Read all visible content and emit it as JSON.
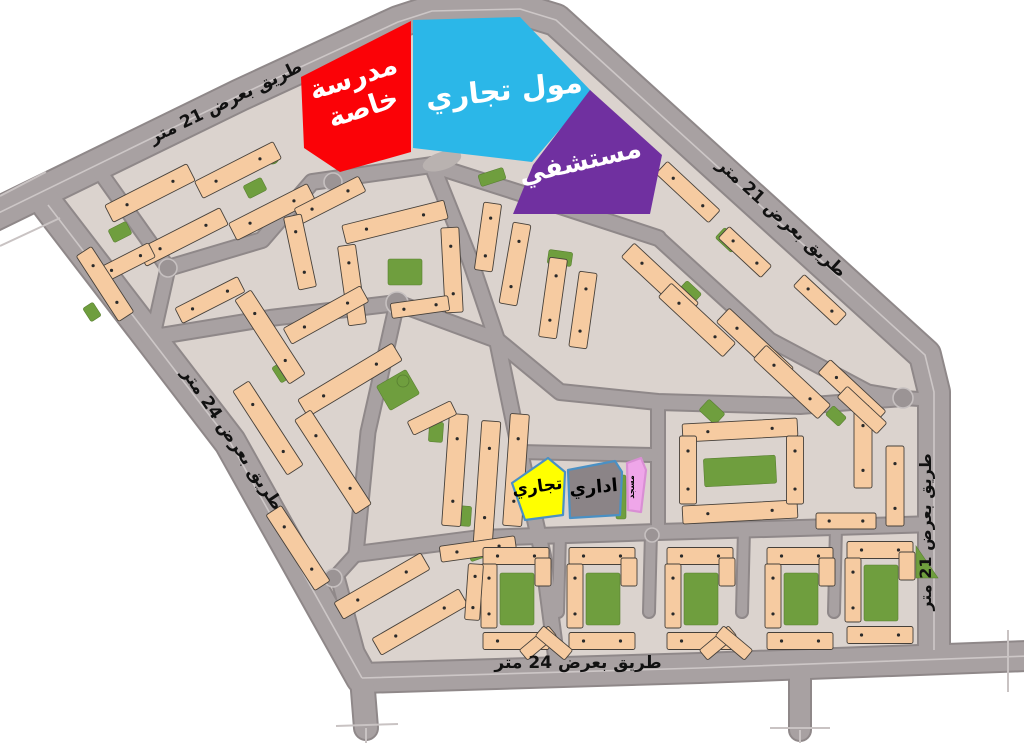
{
  "meta": {
    "description": "Site plan map of a residential district with labeled land-use zones and road widths",
    "background": "#ffffff"
  },
  "colors": {
    "ground": "#dbd3ce",
    "road": "#a8a1a2",
    "road_edge": "#8f8889",
    "road_centerline": "#cdc7c7",
    "tick": "#c9c3c3",
    "building": "#f6cba1",
    "building_stroke": "#46403a",
    "green": "#6f9e3e",
    "green_stroke": "#587f31",
    "oval": "#b9b2b0",
    "roundabout_fill": "#9b9495",
    "roundabout_ring": "#c6c0c0"
  },
  "zones": [
    {
      "id": "private-school",
      "label": "مدرسة خاصة",
      "lines": [
        "مدرسة",
        "خاصة"
      ],
      "fill": "#fb0207",
      "stroke": "none",
      "text_color": "#ffffff",
      "font_size": 27,
      "label_x": 356,
      "label_y": 86,
      "label_rot": -18,
      "points": [
        [
          411,
          21
        ],
        [
          301,
          77
        ],
        [
          304,
          148
        ],
        [
          340,
          172
        ],
        [
          411,
          152
        ]
      ]
    },
    {
      "id": "commercial-mall",
      "label": "مول تجاري",
      "fill": "#2bb7e8",
      "stroke": "none",
      "text_color": "#ffffff",
      "font_size": 29,
      "label_x": 505,
      "label_y": 100,
      "label_rot": -6,
      "points": [
        [
          413,
          20
        ],
        [
          520,
          17
        ],
        [
          592,
          92
        ],
        [
          532,
          162
        ],
        [
          413,
          148
        ]
      ]
    },
    {
      "id": "hospital",
      "label": "مستشفي",
      "fill": "#7030a0",
      "stroke": "none",
      "text_color": "#ffffff",
      "font_size": 26,
      "label_x": 582,
      "label_y": 170,
      "label_rot": -13,
      "points": [
        [
          590,
          90
        ],
        [
          662,
          155
        ],
        [
          650,
          214
        ],
        [
          513,
          214
        ],
        [
          533,
          165
        ]
      ]
    },
    {
      "id": "commercial",
      "label": "تجاري",
      "fill": "#ffff00",
      "stroke": "#4a90c4",
      "text_color": "#000000",
      "font_size": 17,
      "label_x": 538,
      "label_y": 492,
      "label_rot": -8,
      "points": [
        [
          512,
          483
        ],
        [
          548,
          458
        ],
        [
          565,
          472
        ],
        [
          563,
          515
        ],
        [
          525,
          520
        ]
      ]
    },
    {
      "id": "admin",
      "label": "اداري",
      "fill": "#8b8487",
      "stroke": "#4a90c4",
      "text_color": "#000000",
      "font_size": 18,
      "label_x": 594,
      "label_y": 493,
      "label_rot": -5,
      "points": [
        [
          568,
          470
        ],
        [
          615,
          461
        ],
        [
          622,
          472
        ],
        [
          620,
          515
        ],
        [
          570,
          518
        ]
      ]
    },
    {
      "id": "mosque",
      "label": "مسجد",
      "fill": "#efa6e9",
      "stroke": "#d98fd4",
      "text_color": "#000000",
      "font_size": 8,
      "label_x": 634,
      "label_y": 487,
      "label_rot": -90,
      "points": [
        [
          627,
          463
        ],
        [
          641,
          458
        ],
        [
          646,
          470
        ],
        [
          641,
          512
        ],
        [
          628,
          510
        ]
      ]
    }
  ],
  "road_labels": [
    {
      "id": "road-top-left",
      "text": "طريق بعرض 21 متر",
      "x": 228,
      "y": 107,
      "rot": -26,
      "size": 17
    },
    {
      "id": "road-top-right",
      "text": "طريق بعرض 21 متر",
      "x": 778,
      "y": 222,
      "rot": 42,
      "size": 17
    },
    {
      "id": "road-left",
      "text": "طريق بعرض 24 متر",
      "x": 228,
      "y": 442,
      "rot": 56,
      "size": 17
    },
    {
      "id": "road-bottom",
      "text": "طريق بعرض 24 متر",
      "x": 578,
      "y": 668,
      "rot": 0,
      "size": 17
    },
    {
      "id": "road-right",
      "text": "طريق بعرض 21 متر",
      "x": 931,
      "y": 532,
      "rot": -90,
      "size": 16
    }
  ],
  "map": {
    "outline": [
      [
        48,
        205
      ],
      [
        240,
        95
      ],
      [
        398,
        22
      ],
      [
        432,
        11
      ],
      [
        520,
        9
      ],
      [
        556,
        20
      ],
      [
        925,
        355
      ],
      [
        934,
        392
      ],
      [
        934,
        650
      ],
      [
        700,
        668
      ],
      [
        362,
        678
      ],
      [
        230,
        442
      ]
    ],
    "roads": [
      {
        "w": 30,
        "pts": [
          [
            -20,
            222
          ],
          [
            240,
            95
          ],
          [
            398,
            22
          ],
          [
            432,
            11
          ],
          [
            520,
            9
          ],
          [
            556,
            20
          ],
          [
            925,
            355
          ],
          [
            934,
            392
          ],
          [
            934,
            650
          ]
        ],
        "main": true
      },
      {
        "w": 28,
        "pts": [
          [
            362,
            678
          ],
          [
            700,
            668
          ],
          [
            1028,
            656
          ]
        ],
        "main": true
      },
      {
        "w": 30,
        "pts": [
          [
            48,
            205
          ],
          [
            230,
            442
          ],
          [
            362,
            678
          ]
        ],
        "main": true
      },
      {
        "w": 22,
        "pts": [
          [
            362,
            678
          ],
          [
            366,
            728
          ]
        ]
      },
      {
        "w": 20,
        "pts": [
          [
            800,
            670
          ],
          [
            800,
            730
          ]
        ]
      },
      {
        "w": 13,
        "pts": [
          [
            100,
            172
          ],
          [
            168,
            268
          ],
          [
            152,
            340
          ]
        ]
      },
      {
        "w": 14,
        "pts": [
          [
            168,
            268
          ],
          [
            262,
            240
          ],
          [
            312,
            182
          ],
          [
            432,
            165
          ],
          [
            548,
            202
          ],
          [
            658,
            238
          ]
        ]
      },
      {
        "w": 14,
        "pts": [
          [
            432,
            165
          ],
          [
            470,
            260
          ],
          [
            497,
            340
          ],
          [
            520,
            452
          ],
          [
            543,
            556
          ],
          [
            557,
            664
          ]
        ]
      },
      {
        "w": 14,
        "pts": [
          [
            148,
            338
          ],
          [
            270,
            318
          ],
          [
            397,
            303
          ],
          [
            497,
            340
          ]
        ]
      },
      {
        "w": 13,
        "pts": [
          [
            397,
            303
          ],
          [
            368,
            432
          ],
          [
            356,
            554
          ]
        ]
      },
      {
        "w": 14,
        "pts": [
          [
            497,
            340
          ],
          [
            560,
            392
          ],
          [
            658,
            402
          ],
          [
            800,
            406
          ],
          [
            903,
            398
          ]
        ]
      },
      {
        "w": 13,
        "pts": [
          [
            658,
            238
          ],
          [
            770,
            340
          ],
          [
            868,
            392
          ],
          [
            903,
            398
          ]
        ]
      },
      {
        "w": 12,
        "pts": [
          [
            658,
            402
          ],
          [
            658,
            532
          ]
        ]
      },
      {
        "w": 12,
        "pts": [
          [
            520,
            452
          ],
          [
            652,
            455
          ]
        ]
      },
      {
        "w": 14,
        "pts": [
          [
            356,
            554
          ],
          [
            480,
            538
          ],
          [
            658,
            532
          ],
          [
            800,
            528
          ],
          [
            935,
            524
          ]
        ]
      },
      {
        "w": 10,
        "pts": [
          [
            560,
            534
          ],
          [
            558,
            612
          ]
        ]
      },
      {
        "w": 10,
        "pts": [
          [
            651,
            532
          ],
          [
            649,
            612
          ]
        ]
      },
      {
        "w": 10,
        "pts": [
          [
            744,
            529
          ],
          [
            742,
            612
          ]
        ]
      },
      {
        "w": 10,
        "pts": [
          [
            836,
            527
          ],
          [
            834,
            612
          ]
        ]
      },
      {
        "w": 12,
        "pts": [
          [
            903,
            398
          ],
          [
            936,
            400
          ]
        ]
      },
      {
        "w": 12,
        "pts": [
          [
            356,
            554
          ],
          [
            337,
            575
          ],
          [
            364,
            676
          ]
        ]
      }
    ],
    "ticks": [
      [
        [
          0,
          196
        ],
        [
          46,
          172
        ]
      ],
      [
        [
          0,
          246
        ],
        [
          60,
          218
        ]
      ],
      [
        [
          366,
          728
        ],
        [
          366,
          743
        ]
      ],
      [
        [
          336,
          726
        ],
        [
          398,
          724
        ]
      ],
      [
        [
          800,
          730
        ],
        [
          800,
          743
        ]
      ],
      [
        [
          770,
          728
        ],
        [
          830,
          728
        ]
      ],
      [
        [
          1008,
          630
        ],
        [
          1008,
          692
        ]
      ]
    ],
    "roundabouts": [
      [
        168,
        268,
        9
      ],
      [
        397,
        303,
        11
      ],
      [
        903,
        398,
        10
      ],
      [
        333,
        578,
        9
      ],
      [
        652,
        535,
        7
      ],
      [
        333,
        182,
        9
      ]
    ],
    "oval": {
      "cx": 442,
      "cy": 161,
      "rx": 20,
      "ry": 9,
      "rot": -18
    },
    "buildings": [
      [
        150,
        193,
        92,
        19,
        -27
      ],
      [
        183,
        237,
        92,
        19,
        -27
      ],
      [
        126,
        263,
        58,
        16,
        -27
      ],
      [
        238,
        170,
        88,
        19,
        -27
      ],
      [
        272,
        212,
        88,
        19,
        -27
      ],
      [
        105,
        284,
        78,
        18,
        57
      ],
      [
        210,
        300,
        70,
        17,
        -27
      ],
      [
        330,
        200,
        72,
        17,
        -27
      ],
      [
        300,
        252,
        18,
        74,
        -12
      ],
      [
        395,
        222,
        105,
        19,
        -14
      ],
      [
        352,
        285,
        18,
        80,
        -8
      ],
      [
        452,
        270,
        18,
        85,
        -3
      ],
      [
        420,
        307,
        58,
        15,
        -8
      ],
      [
        488,
        237,
        18,
        68,
        8
      ],
      [
        515,
        264,
        18,
        82,
        10
      ],
      [
        553,
        298,
        18,
        80,
        8
      ],
      [
        583,
        310,
        18,
        76,
        8
      ],
      [
        270,
        337,
        100,
        19,
        57
      ],
      [
        268,
        428,
        100,
        19,
        57
      ],
      [
        350,
        380,
        110,
        20,
        -31
      ],
      [
        326,
        315,
        88,
        18,
        -29
      ],
      [
        333,
        462,
        112,
        19,
        57
      ],
      [
        298,
        548,
        90,
        18,
        57
      ],
      [
        382,
        586,
        100,
        19,
        -30
      ],
      [
        420,
        622,
        100,
        19,
        -30
      ],
      [
        455,
        470,
        19,
        112,
        4
      ],
      [
        487,
        483,
        19,
        124,
        4
      ],
      [
        516,
        470,
        19,
        112,
        4
      ],
      [
        478,
        549,
        76,
        16,
        -8
      ],
      [
        432,
        418,
        48,
        15,
        -26
      ],
      [
        688,
        192,
        72,
        17,
        43
      ],
      [
        660,
        280,
        88,
        19,
        43
      ],
      [
        697,
        320,
        88,
        19,
        43
      ],
      [
        755,
        345,
        88,
        19,
        43
      ],
      [
        792,
        382,
        88,
        19,
        43
      ],
      [
        852,
        392,
        76,
        18,
        43
      ],
      [
        745,
        252,
        58,
        16,
        43
      ],
      [
        820,
        300,
        58,
        16,
        43
      ],
      [
        740,
        430,
        115,
        18,
        -3
      ],
      [
        740,
        512,
        115,
        18,
        -3
      ],
      [
        688,
        470,
        17,
        68,
        0
      ],
      [
        795,
        470,
        17,
        68,
        0
      ],
      [
        863,
        448,
        18,
        80,
        0
      ],
      [
        895,
        486,
        18,
        80,
        0
      ],
      [
        846,
        521,
        60,
        16,
        0
      ],
      [
        862,
        410,
        54,
        15,
        43
      ],
      [
        516,
        556,
        66,
        17,
        0
      ],
      [
        489,
        596,
        16,
        64,
        0
      ],
      [
        516,
        641,
        66,
        17,
        0
      ],
      [
        543,
        572,
        16,
        28,
        0
      ],
      [
        602,
        556,
        66,
        17,
        0
      ],
      [
        575,
        596,
        16,
        64,
        0
      ],
      [
        602,
        641,
        66,
        17,
        0
      ],
      [
        629,
        572,
        16,
        28,
        0
      ],
      [
        700,
        556,
        66,
        17,
        0
      ],
      [
        673,
        596,
        16,
        64,
        0
      ],
      [
        700,
        641,
        66,
        17,
        0
      ],
      [
        727,
        572,
        16,
        28,
        0
      ],
      [
        800,
        556,
        66,
        17,
        0
      ],
      [
        773,
        596,
        16,
        64,
        0
      ],
      [
        800,
        641,
        66,
        17,
        0
      ],
      [
        827,
        572,
        16,
        28,
        0
      ],
      [
        880,
        550,
        66,
        17,
        0
      ],
      [
        853,
        590,
        16,
        64,
        0
      ],
      [
        880,
        635,
        66,
        17,
        0
      ],
      [
        907,
        566,
        16,
        28,
        0
      ],
      [
        474,
        592,
        15,
        56,
        4
      ],
      [
        538,
        643,
        38,
        13,
        -40
      ],
      [
        554,
        643,
        38,
        13,
        40
      ],
      [
        718,
        643,
        38,
        13,
        -40
      ],
      [
        734,
        643,
        38,
        13,
        40
      ]
    ],
    "greens": [
      [
        120,
        232,
        20,
        14,
        -27
      ],
      [
        255,
        188,
        20,
        14,
        -27
      ],
      [
        92,
        312,
        16,
        12,
        57
      ],
      [
        405,
        272,
        34,
        26,
        0
      ],
      [
        560,
        258,
        24,
        14,
        8
      ],
      [
        398,
        390,
        34,
        28,
        -30
      ],
      [
        282,
        372,
        18,
        13,
        57
      ],
      [
        436,
        432,
        14,
        20,
        4
      ],
      [
        464,
        516,
        14,
        20,
        4
      ],
      [
        740,
        471,
        72,
        28,
        -3
      ],
      [
        712,
        412,
        22,
        15,
        43
      ],
      [
        836,
        416,
        18,
        12,
        43
      ],
      [
        621,
        497,
        10,
        44,
        0
      ],
      [
        482,
        550,
        28,
        15,
        -20
      ],
      [
        492,
        177,
        26,
        12,
        -18
      ],
      [
        728,
        240,
        22,
        14,
        43
      ],
      [
        690,
        292,
        20,
        13,
        43
      ],
      [
        517,
        599,
        34,
        52,
        0
      ],
      [
        603,
        599,
        34,
        52,
        0
      ],
      [
        701,
        599,
        34,
        52,
        0
      ],
      [
        801,
        599,
        34,
        52,
        0
      ],
      [
        881,
        593,
        34,
        56,
        0
      ]
    ],
    "green_triangles": [
      [
        [
          916,
          546
        ],
        [
          938,
          578
        ],
        [
          916,
          578
        ]
      ]
    ],
    "green_circles": [
      [
        272,
        157,
        7
      ],
      [
        403,
        381,
        6
      ]
    ]
  }
}
